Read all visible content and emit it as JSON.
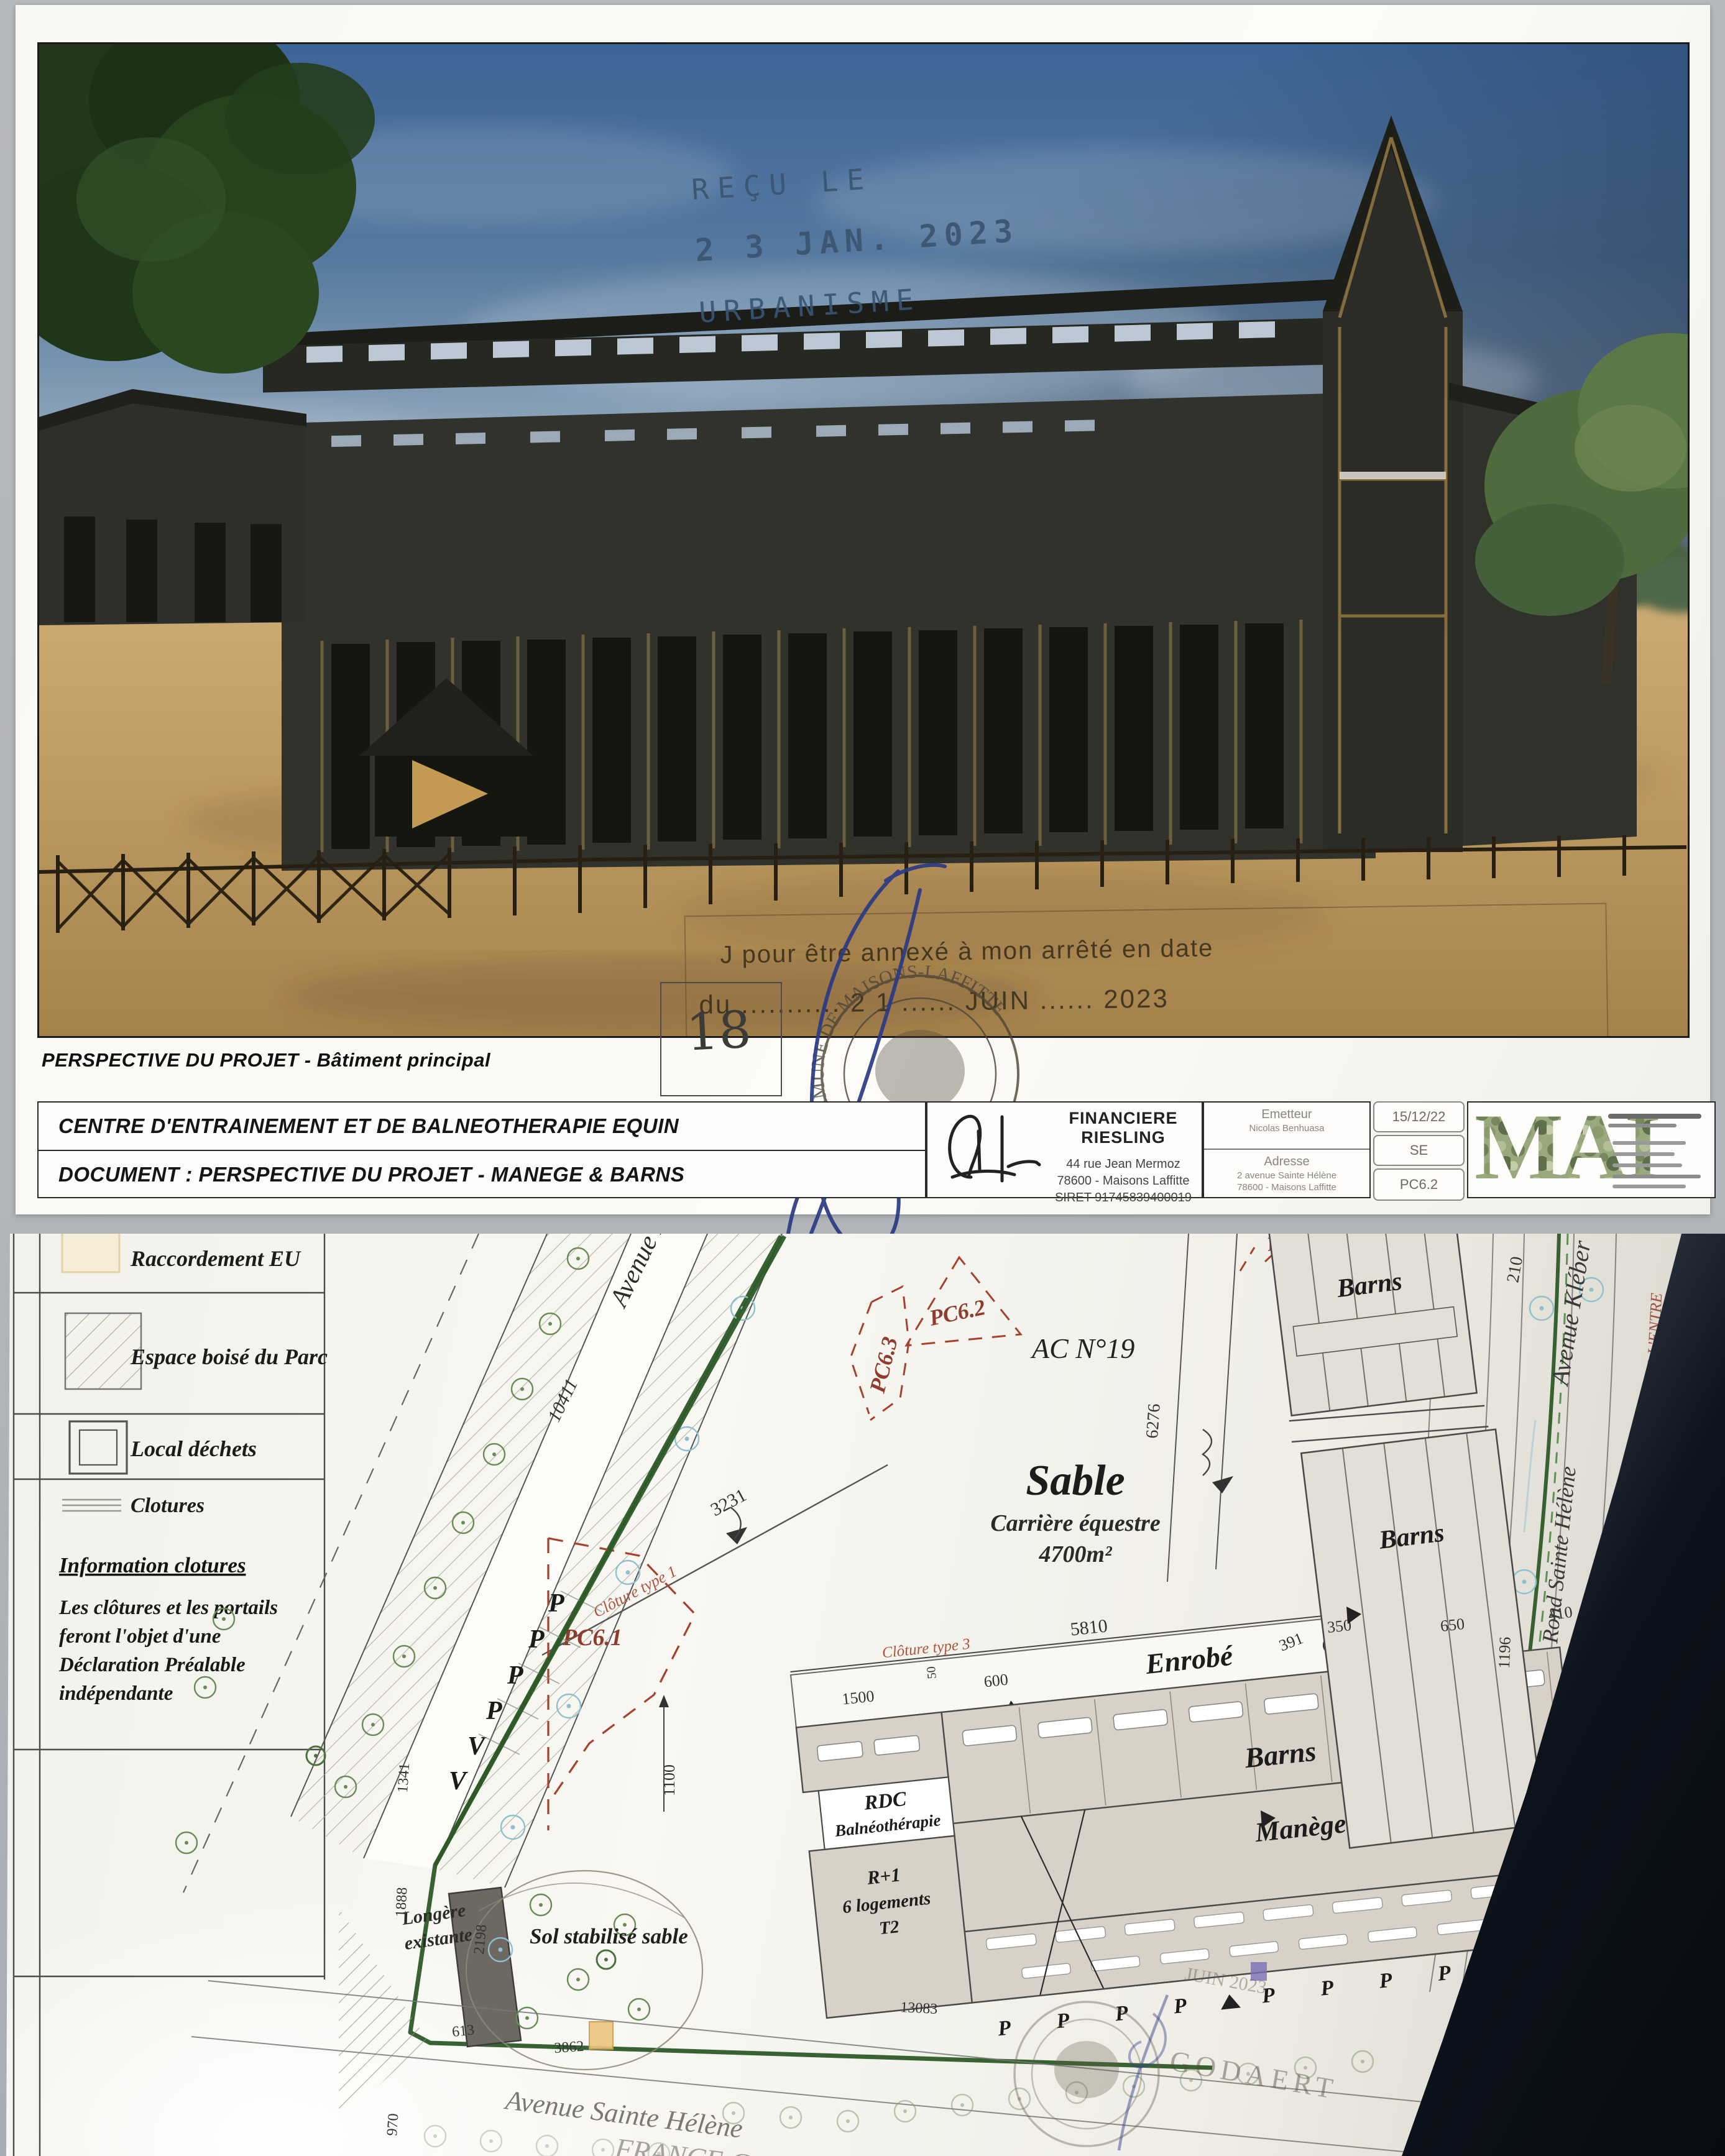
{
  "colors": {
    "boundary_green": "#2d5a28",
    "plan_red": "#a3432f",
    "stamp_blue": "#3a5571",
    "ink_blue": "#2b3a85",
    "building_tan": "#d8d1c7",
    "shadow_dark": "#0d131d"
  },
  "page1": {
    "received_stamp": {
      "l1": "REÇU LE",
      "l2": "2 3  JAN. 2023",
      "l3": "URBANISME"
    },
    "annex_stamp": {
      "l1": "J pour être annexé à mon arrêté en date",
      "l2": "du ........... 2 1 ...... JUIN ...... 2023"
    },
    "seal": {
      "ring": "COMMUNE DE MAISONS-LAFFITTE",
      "sub": "(Les Yvelines)",
      "star": "★"
    },
    "plate": "18",
    "signature_name": "J. GODAERT",
    "caption": "PERSPECTIVE DU PROJET - Bâtiment principal",
    "titleblock": {
      "project": "CENTRE D'ENTRAINEMENT ET DE BALNEOTHERAPIE EQUIN",
      "document": "DOCUMENT : PERSPECTIVE DU PROJET - MANEGE & BARNS",
      "company_name": "FINANCIERE RIESLING",
      "company_addr1": "44 rue Jean Mermoz",
      "company_addr2": "78600 - Maisons Laffitte",
      "company_siret": "SIRET 91745839400019",
      "emitter_label": "Emetteur",
      "emitter_value": "Nicolas Benhuasa",
      "adresse_label": "Adresse",
      "adresse_value1": "2 avenue Sainte Hélène",
      "adresse_value2": "78600 - Maisons Laffitte",
      "date": "15/12/22",
      "phase": "SE",
      "ref": "PC6.2",
      "logo": "MAI"
    }
  },
  "page2": {
    "legend": {
      "items": [
        {
          "label": "Raccordement EU"
        },
        {
          "label": "Espace boisé du Parc"
        },
        {
          "label": "Local déchets"
        },
        {
          "label": "Clotures"
        }
      ],
      "info_title": "Information clotures",
      "info_lines": [
        "Les clôtures et les portails",
        "feront l'objet d'une",
        "Déclaration Préalable",
        "indépendante"
      ]
    },
    "plan": {
      "parcel": "AC N°19",
      "parcel2": "AC N°20",
      "sable": "Sable",
      "carriere": "Carrière équestre",
      "area": "4700m²",
      "pc61": "PC6.1",
      "pc62": "PC6.2",
      "pc63": "PC6.3",
      "pc64": "PC6.4",
      "enrobe": "Enrobé",
      "barns": "Barns",
      "manege": "Manège",
      "rdc": "RDC",
      "balneo": "Balnéothérapie",
      "r1": "R+1",
      "logements": "6 logements",
      "t2": "T2",
      "longere1": "Longère",
      "longere2": "existante",
      "sol": "Sol stabilisé sable",
      "av_dau": "Avenue Dau",
      "av_helene": "Avenue Sainte Hélène",
      "av_kleber": "Avenue Kléber",
      "rond": "Rond Sainte Hélène",
      "assoc": "ASSOCIATION SYNDICALE POUR L'ENTRE",
      "galop": "FRANCE GALOP",
      "cl1": "Clôture type 1",
      "cl3": "Clôture type 3",
      "p": "P",
      "v": "V",
      "godaert": "GODAERT",
      "juin": "JUIN 2023",
      "dims": {
        "d10411": "10411",
        "d3231": "3231",
        "d5810": "5810",
        "d1500": "1500",
        "d600": "600",
        "d6000": "6000",
        "d6276": "6276",
        "d1100": "1100",
        "d1341": "1341",
        "d1888": "1888",
        "d2198": "2198",
        "d613": "613",
        "d970": "970",
        "d3862": "3862",
        "d210": "210",
        "d391": "391",
        "d350": "350",
        "d650": "650",
        "d1196": "1196",
        "d410": "410",
        "d13083": "13083",
        "d50": "50"
      }
    }
  }
}
